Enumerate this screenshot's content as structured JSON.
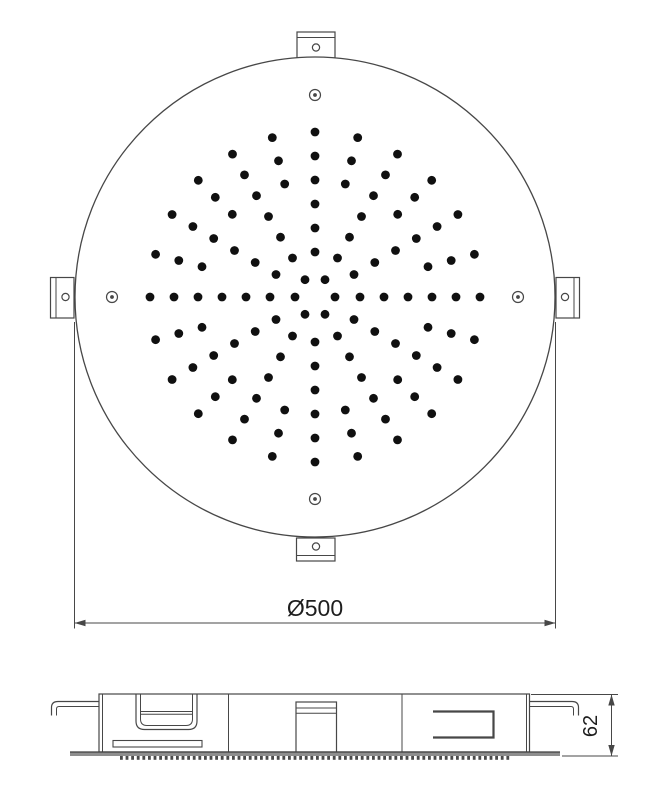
{
  "drawing": {
    "background": "#ffffff",
    "line_color": "#474747",
    "dot_color": "#101010",
    "plate_color": "#8e8e8e",
    "nozzle_strip_color": "#4a4a4a",
    "text_color": "#1e1e1e",
    "top_view": {
      "circle": {
        "cx": 315,
        "cy": 297,
        "r": 240
      },
      "nozzle_dot_radius": 4.4,
      "nozzle_rings": [
        {
          "radius": 20,
          "count": 6,
          "start_deg": 0
        },
        {
          "radius": 45,
          "count": 12,
          "start_deg": 0
        },
        {
          "radius": 69,
          "count": 12,
          "start_deg": 0
        },
        {
          "radius": 93,
          "count": 12,
          "start_deg": 0
        },
        {
          "radius": 117,
          "count": 24,
          "start_deg": 0
        },
        {
          "radius": 141,
          "count": 24,
          "start_deg": 0
        },
        {
          "radius": 165,
          "count": 24,
          "start_deg": 0
        }
      ],
      "screws": {
        "radius_outer": 5.5,
        "radius_inner": 1.9,
        "positions": [
          {
            "x": 315,
            "y": 95
          },
          {
            "x": 518,
            "y": 297
          },
          {
            "x": 315,
            "y": 499
          },
          {
            "x": 112,
            "y": 297
          }
        ]
      },
      "brackets": [
        {
          "side": "top",
          "x": 297,
          "y": 32,
          "w": 38,
          "h": 26,
          "lip_offset": 5.5,
          "hole": {
            "x": 316,
            "y": 47.5,
            "r": 3.6
          }
        },
        {
          "side": "right",
          "x": 556,
          "y": 277.5,
          "w": 23.5,
          "h": 40.5,
          "lip_offset": 5.5,
          "hole": {
            "x": 565,
            "y": 297,
            "r": 3.6
          }
        },
        {
          "side": "bottom",
          "x": 296.5,
          "y": 538,
          "w": 38.5,
          "h": 23,
          "lip_offset": 5.5,
          "hole": {
            "x": 316,
            "y": 546.5,
            "r": 3.6
          }
        },
        {
          "side": "left",
          "x": 50.5,
          "y": 277.5,
          "w": 23.5,
          "h": 40.5,
          "lip_offset": 5.5,
          "hole": {
            "x": 65.5,
            "y": 297,
            "r": 3.6
          }
        }
      ]
    },
    "dimension_width": {
      "label": "Ø500",
      "value": 500,
      "line_y": 623,
      "x1": 74.5,
      "x2": 555.5,
      "ext_y_top": 322,
      "ext_y_bottom": 628.5,
      "label_x": 315,
      "label_y": 616,
      "font_size": 23
    },
    "dimension_height": {
      "label": "62",
      "value": 62,
      "line_x": 611.5,
      "y1": 694.5,
      "y2": 756,
      "ext_top_x1": 531,
      "ext_bottom_x1": 562,
      "ext_x2": 618,
      "label_x": 597,
      "label_y": 726,
      "font_size": 20
    },
    "side_view": {
      "body": {
        "x": 99,
        "y": 694,
        "w": 430.5,
        "h": 58,
        "inner_left_x": 102.5,
        "inner_right_x": 526.5
      },
      "dividers_x": [
        228.5,
        402
      ],
      "plate": {
        "x": 70,
        "y": 752,
        "w": 490,
        "h": 4
      },
      "nozzle_strip": {
        "x1": 120,
        "x2": 508,
        "step": 5.6,
        "w": 2.8,
        "h": 3.8,
        "y": 756
      },
      "hooks": [
        {
          "side": "left",
          "outer": "M 99 701.5 H 58 Q 51.5 701.5 51.5 707.5 V 715.5",
          "inner": "M 99 706.5 H 59 Q 56.5 706.5 56.5 709 V 715.5"
        },
        {
          "side": "right",
          "outer": "M 529 701.5 H 572 Q 578.5 701.5 578.5 707.5 V 715.5",
          "inner": "M 529 706.5 H 571 Q 573.5 706.5 573.5 709 V 715.5"
        }
      ],
      "cup": {
        "outer": "M 136 694 V 721 Q 136 729.5 144.5 729.5 H 188.5 Q 197 729.5 197 721 V 694",
        "inner": "M 140.5 694 V 719 Q 140.5 725.5 147 725.5 H 186 Q 192.5 725.5 192.5 719 V 694",
        "band_y": [
          711.5,
          714.2
        ],
        "band_x1": 140.5,
        "band_x2": 192.5
      },
      "slot": {
        "x": 113,
        "y": 740.5,
        "w": 89,
        "h": 6.5
      },
      "inlet": {
        "x": 296,
        "y": 702,
        "w": 40.5,
        "h": 50,
        "band_y": [
          708,
          713.2
        ]
      },
      "bracket_profile": {
        "path": "M 433 711.5 H 493.5 V 737.5 H 433",
        "stroke_width": 2.2
      }
    }
  }
}
